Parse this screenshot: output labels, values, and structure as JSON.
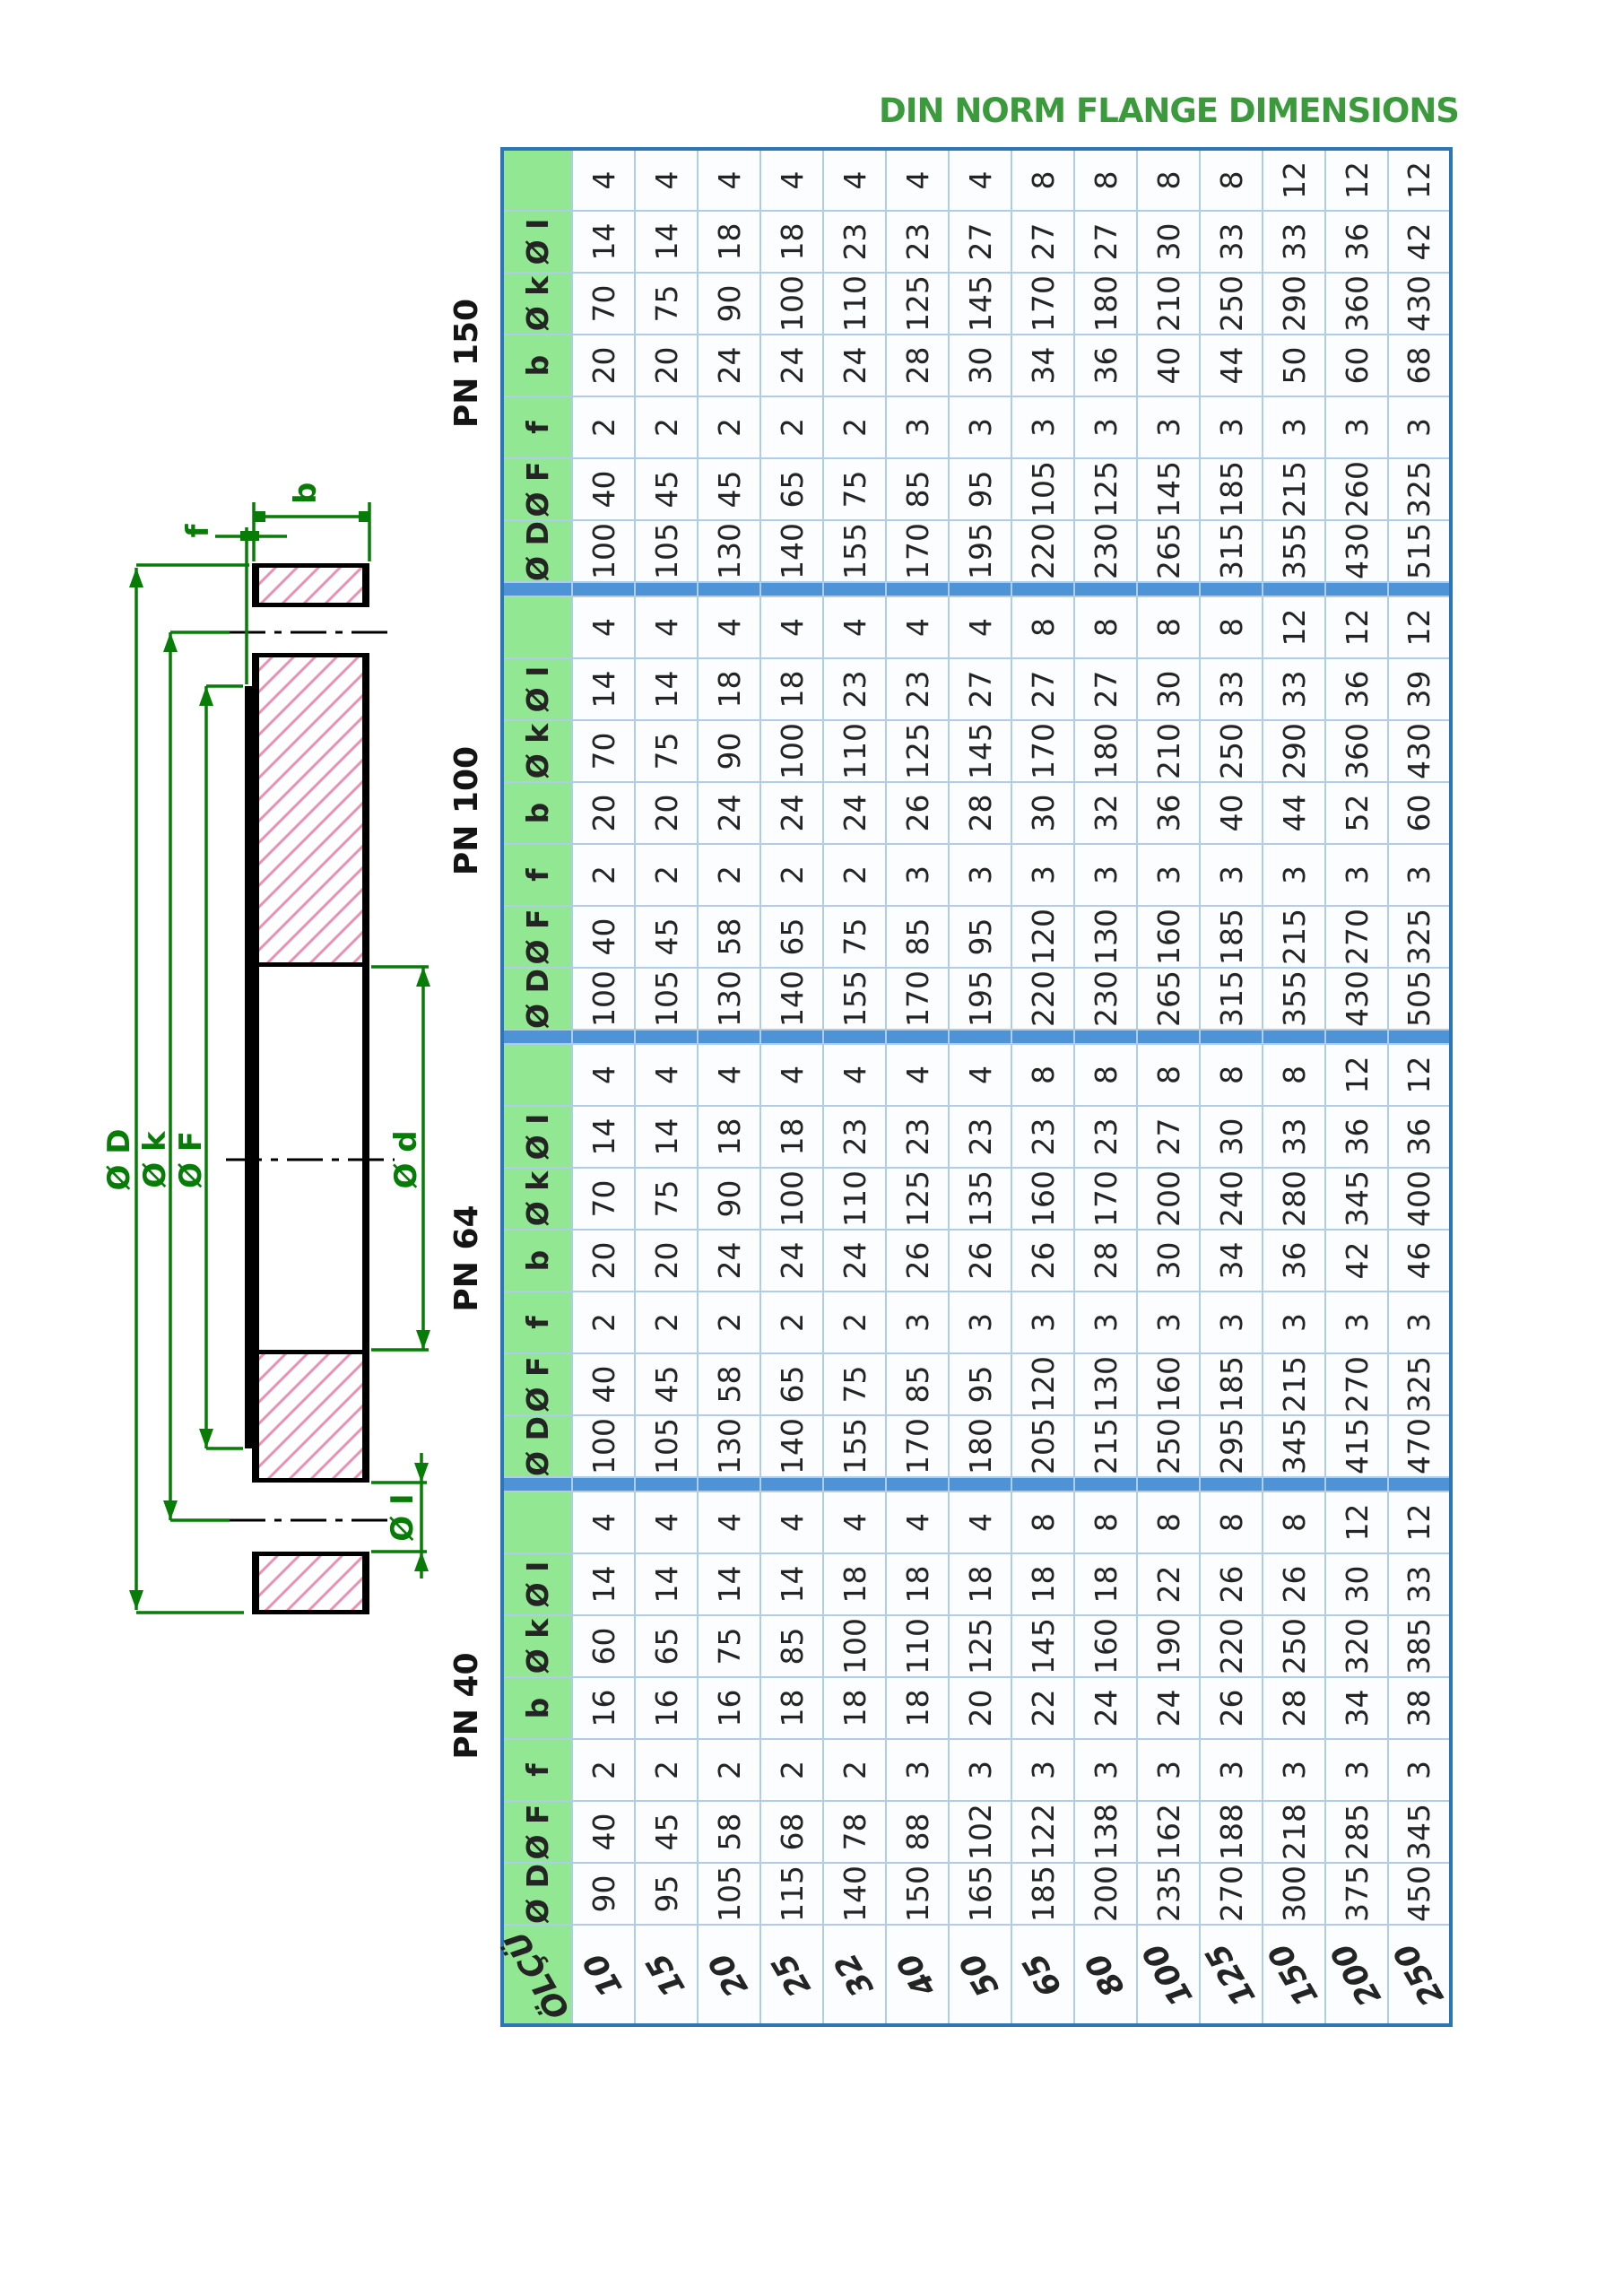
{
  "title": "DIN NORM FLANGE DIMENSIONS",
  "table": {
    "size_header": "ÖLÇÜ",
    "sizes": [
      "10",
      "15",
      "20",
      "25",
      "32",
      "40",
      "50",
      "65",
      "80",
      "100",
      "125",
      "150",
      "200",
      "250"
    ],
    "col_headers": [
      "Ø D",
      "Ø F",
      "f",
      "b",
      "Ø k",
      "Ø I",
      ""
    ],
    "groups": [
      {
        "label": "PN 40",
        "D": [
          90,
          95,
          105,
          115,
          140,
          150,
          165,
          185,
          200,
          235,
          270,
          300,
          375,
          450
        ],
        "F": [
          40,
          45,
          58,
          68,
          78,
          88,
          102,
          122,
          138,
          162,
          188,
          218,
          285,
          345
        ],
        "f": [
          2,
          2,
          2,
          2,
          2,
          3,
          3,
          3,
          3,
          3,
          3,
          3,
          3,
          3
        ],
        "b": [
          16,
          16,
          16,
          18,
          18,
          18,
          20,
          22,
          24,
          24,
          26,
          28,
          34,
          38
        ],
        "k": [
          60,
          65,
          75,
          85,
          100,
          110,
          125,
          145,
          160,
          190,
          220,
          250,
          320,
          385
        ],
        "I": [
          14,
          14,
          14,
          14,
          18,
          18,
          18,
          18,
          18,
          22,
          26,
          26,
          30,
          33
        ],
        "n": [
          4,
          4,
          4,
          4,
          4,
          4,
          4,
          8,
          8,
          8,
          8,
          8,
          12,
          12
        ]
      },
      {
        "label": "PN 64",
        "D": [
          100,
          105,
          130,
          140,
          155,
          170,
          180,
          205,
          215,
          250,
          295,
          345,
          415,
          470
        ],
        "F": [
          40,
          45,
          58,
          65,
          75,
          85,
          95,
          120,
          130,
          160,
          185,
          215,
          270,
          325
        ],
        "f": [
          2,
          2,
          2,
          2,
          2,
          3,
          3,
          3,
          3,
          3,
          3,
          3,
          3,
          3
        ],
        "b": [
          20,
          20,
          24,
          24,
          24,
          26,
          26,
          26,
          28,
          30,
          34,
          36,
          42,
          46
        ],
        "k": [
          70,
          75,
          90,
          100,
          110,
          125,
          135,
          160,
          170,
          200,
          240,
          280,
          345,
          400
        ],
        "I": [
          14,
          14,
          18,
          18,
          23,
          23,
          23,
          23,
          23,
          27,
          30,
          33,
          36,
          36
        ],
        "n": [
          4,
          4,
          4,
          4,
          4,
          4,
          4,
          8,
          8,
          8,
          8,
          8,
          12,
          12
        ]
      },
      {
        "label": "PN 100",
        "D": [
          100,
          105,
          130,
          140,
          155,
          170,
          195,
          220,
          230,
          265,
          315,
          355,
          430,
          505
        ],
        "F": [
          40,
          45,
          58,
          65,
          75,
          85,
          95,
          120,
          130,
          160,
          185,
          215,
          270,
          325
        ],
        "f": [
          2,
          2,
          2,
          2,
          2,
          3,
          3,
          3,
          3,
          3,
          3,
          3,
          3,
          3
        ],
        "b": [
          20,
          20,
          24,
          24,
          24,
          26,
          28,
          30,
          32,
          36,
          40,
          44,
          52,
          60
        ],
        "k": [
          70,
          75,
          90,
          100,
          110,
          125,
          145,
          170,
          180,
          210,
          250,
          290,
          360,
          430
        ],
        "I": [
          14,
          14,
          18,
          18,
          23,
          23,
          27,
          27,
          27,
          30,
          33,
          33,
          36,
          39
        ],
        "n": [
          4,
          4,
          4,
          4,
          4,
          4,
          4,
          8,
          8,
          8,
          8,
          12,
          12,
          12
        ]
      },
      {
        "label": "PN 150",
        "D": [
          100,
          105,
          130,
          140,
          155,
          170,
          195,
          220,
          230,
          265,
          315,
          355,
          430,
          515
        ],
        "F": [
          40,
          45,
          45,
          65,
          75,
          85,
          95,
          105,
          125,
          145,
          185,
          215,
          260,
          325
        ],
        "f": [
          2,
          2,
          2,
          2,
          2,
          3,
          3,
          3,
          3,
          3,
          3,
          3,
          3,
          3
        ],
        "b": [
          20,
          20,
          24,
          24,
          24,
          28,
          30,
          34,
          36,
          40,
          44,
          50,
          60,
          68
        ],
        "k": [
          70,
          75,
          90,
          100,
          110,
          125,
          145,
          170,
          180,
          210,
          250,
          290,
          360,
          430
        ],
        "I": [
          14,
          14,
          18,
          18,
          23,
          23,
          27,
          27,
          27,
          30,
          33,
          33,
          36,
          42
        ],
        "n": [
          4,
          4,
          4,
          4,
          4,
          4,
          4,
          8,
          8,
          8,
          8,
          12,
          12,
          12
        ]
      }
    ]
  },
  "drawing": {
    "labels": {
      "b": "b",
      "f": "f",
      "D": "Ø D",
      "k": "Ø k",
      "F": "Ø F",
      "d": "Ø d",
      "I": "Ø I"
    }
  },
  "colors": {
    "title_green": "#3a9a3c",
    "header_green": "#92e792",
    "grid_blue": "#afcde8",
    "separator_blue": "#4e93d6",
    "outer_border_blue": "#2e75b6",
    "drawing_green": "#077d07",
    "hatch_pink": "#f08fb4"
  }
}
